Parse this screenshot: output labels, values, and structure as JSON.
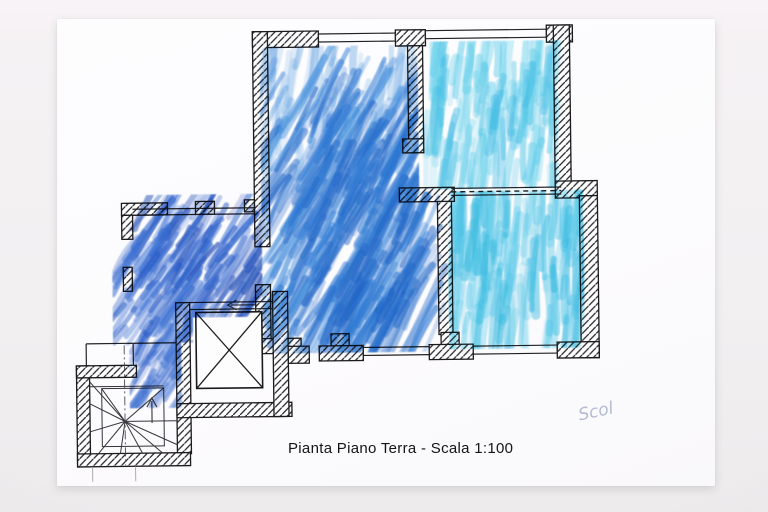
{
  "document": {
    "title": "Pianta Piano Terra - Scala 1:100",
    "signature": "Scol"
  },
  "colors": {
    "background": "#f3f1f2",
    "paper": "#fdfdfe",
    "ink": "#1c1c1e",
    "hatch": "#26262a",
    "pencil_light": "#999999",
    "signature_color": "#97a0c2",
    "crayon_blue": "#2e7bd6",
    "crayon_blue_light": "#7fb6ea",
    "crayon_dark_blue": "#2a5ec9",
    "crayon_cyan": "#4cc8e9"
  },
  "crayon_regions": [
    {
      "name": "main-room-vertical-wash",
      "colors": [
        "#7fb6ea",
        "#5ea0e0"
      ]
    },
    {
      "name": "main-room-diagonal",
      "colors": [
        "#2e7bd6",
        "#4b96e0",
        "#1f66c8"
      ]
    },
    {
      "name": "main-room-core",
      "colors": [
        "#2e7bd6",
        "#1f66c8"
      ]
    },
    {
      "name": "upper-right-room",
      "colors": [
        "#55cdea",
        "#3fbde4",
        "#7cd9ef"
      ]
    },
    {
      "name": "lower-right-room",
      "colors": [
        "#45c6e8",
        "#2fb9e0",
        "#6fd4ee"
      ]
    },
    {
      "name": "porch-dense",
      "colors": [
        "#2a5ec9",
        "#3f74d6",
        "#1d49b4"
      ]
    },
    {
      "name": "porch-sparse",
      "colors": [
        "#2a5ec9",
        "#3f74d6"
      ]
    },
    {
      "name": "porch-strip",
      "colors": [
        "#3f74d6",
        "#2a5ec9"
      ]
    }
  ]
}
